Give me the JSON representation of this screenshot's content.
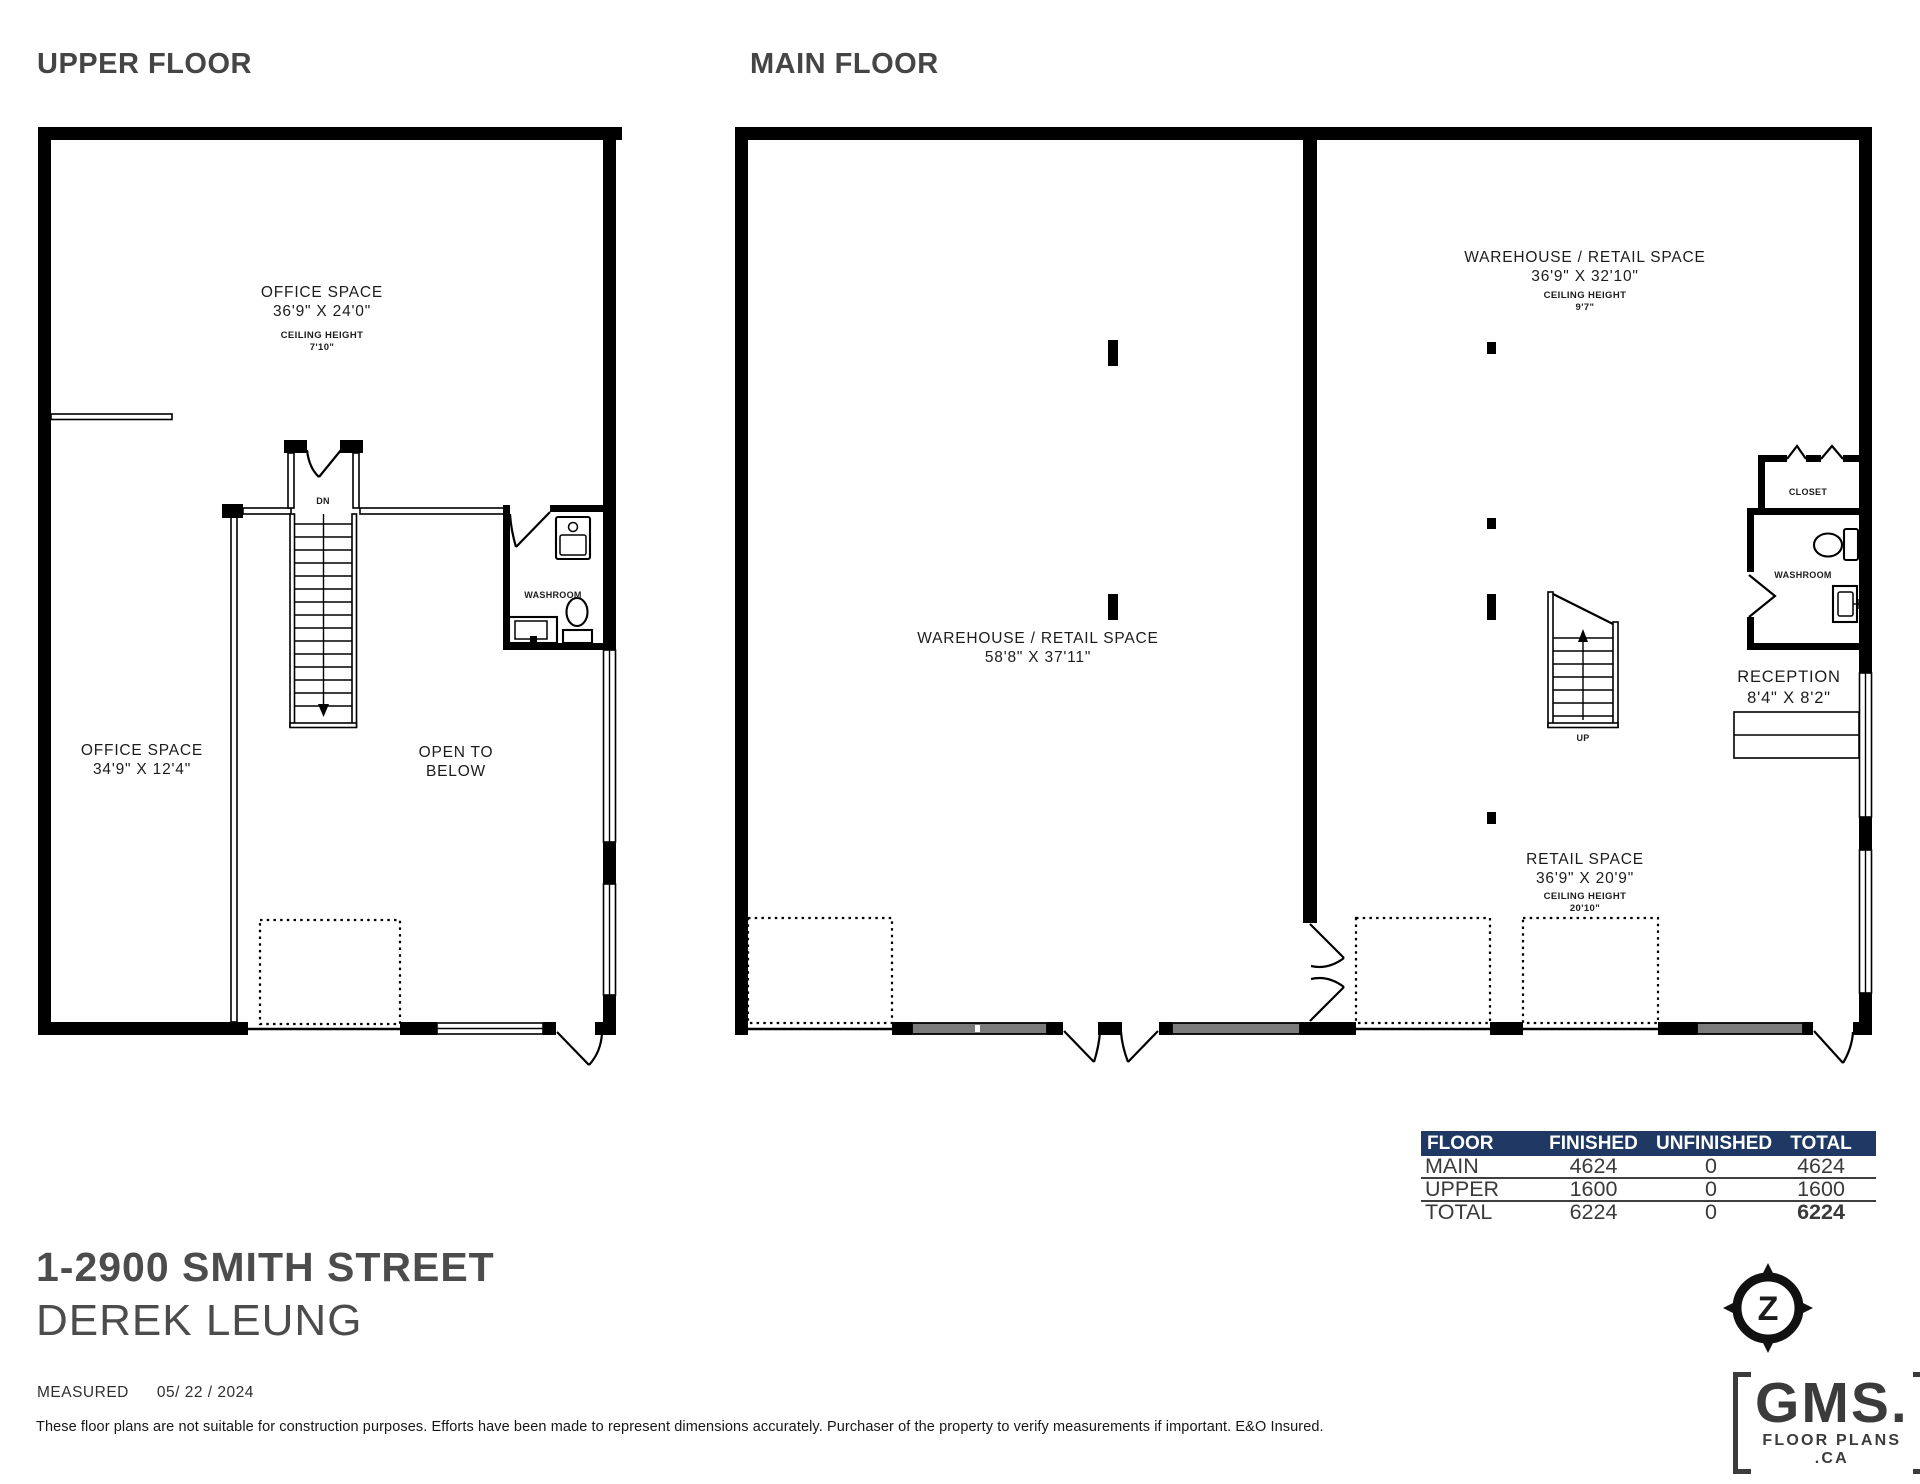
{
  "titles": {
    "upper": "UPPER FLOOR",
    "main": "MAIN FLOOR"
  },
  "upper_floor": {
    "office1": {
      "name": "OFFICE SPACE",
      "dims": "36'9\" X 24'0\"",
      "ch_label": "CEILING HEIGHT",
      "ch": "7'10\""
    },
    "office2": {
      "name": "OFFICE SPACE",
      "dims": "34'9\" X 12'4\""
    },
    "open_below": {
      "l1": "OPEN TO",
      "l2": "BELOW"
    },
    "dn": "DN",
    "washroom": "WASHROOM"
  },
  "main_floor": {
    "warehouse_left": {
      "name": "WAREHOUSE / RETAIL SPACE",
      "dims": "58'8\" X 37'11\""
    },
    "warehouse_right": {
      "name": "WAREHOUSE / RETAIL SPACE",
      "dims": "36'9\" X 32'10\"",
      "ch_label": "CEILING HEIGHT",
      "ch": "9'7\""
    },
    "retail": {
      "name": "RETAIL SPACE",
      "dims": "36'9\" X 20'9\"",
      "ch_label": "CEILING HEIGHT",
      "ch": "20'10\""
    },
    "reception": {
      "name": "RECEPTION",
      "dims": "8'4\" X 8'2\""
    },
    "closet": "CLOSET",
    "washroom": "WASHROOM",
    "up": "UP"
  },
  "area_table": {
    "header_bg": "#1f3864",
    "header": [
      "FLOOR",
      "FINISHED",
      "UNFINISHED",
      "TOTAL"
    ],
    "rows": [
      {
        "floor": "MAIN",
        "finished": "4624",
        "unfinished": "0",
        "total": "4624"
      },
      {
        "floor": "UPPER",
        "finished": "1600",
        "unfinished": "0",
        "total": "1600"
      },
      {
        "floor": "TOTAL",
        "finished": "6224",
        "unfinished": "0",
        "total": "6224"
      }
    ]
  },
  "footer": {
    "address": "1-2900 SMITH STREET",
    "client": "DEREK LEUNG",
    "measured_label": "MEASURED",
    "measured_date": "05/ 22 / 2024",
    "disclaimer": "These floor plans are not suitable for construction purposes. Efforts have been made to represent dimensions accurately.  Purchaser of the property to verify measurements if important.  E&O Insured."
  },
  "logo": {
    "name": "GMS.",
    "sub": "FLOOR PLANS .CA",
    "compass": "Z"
  }
}
